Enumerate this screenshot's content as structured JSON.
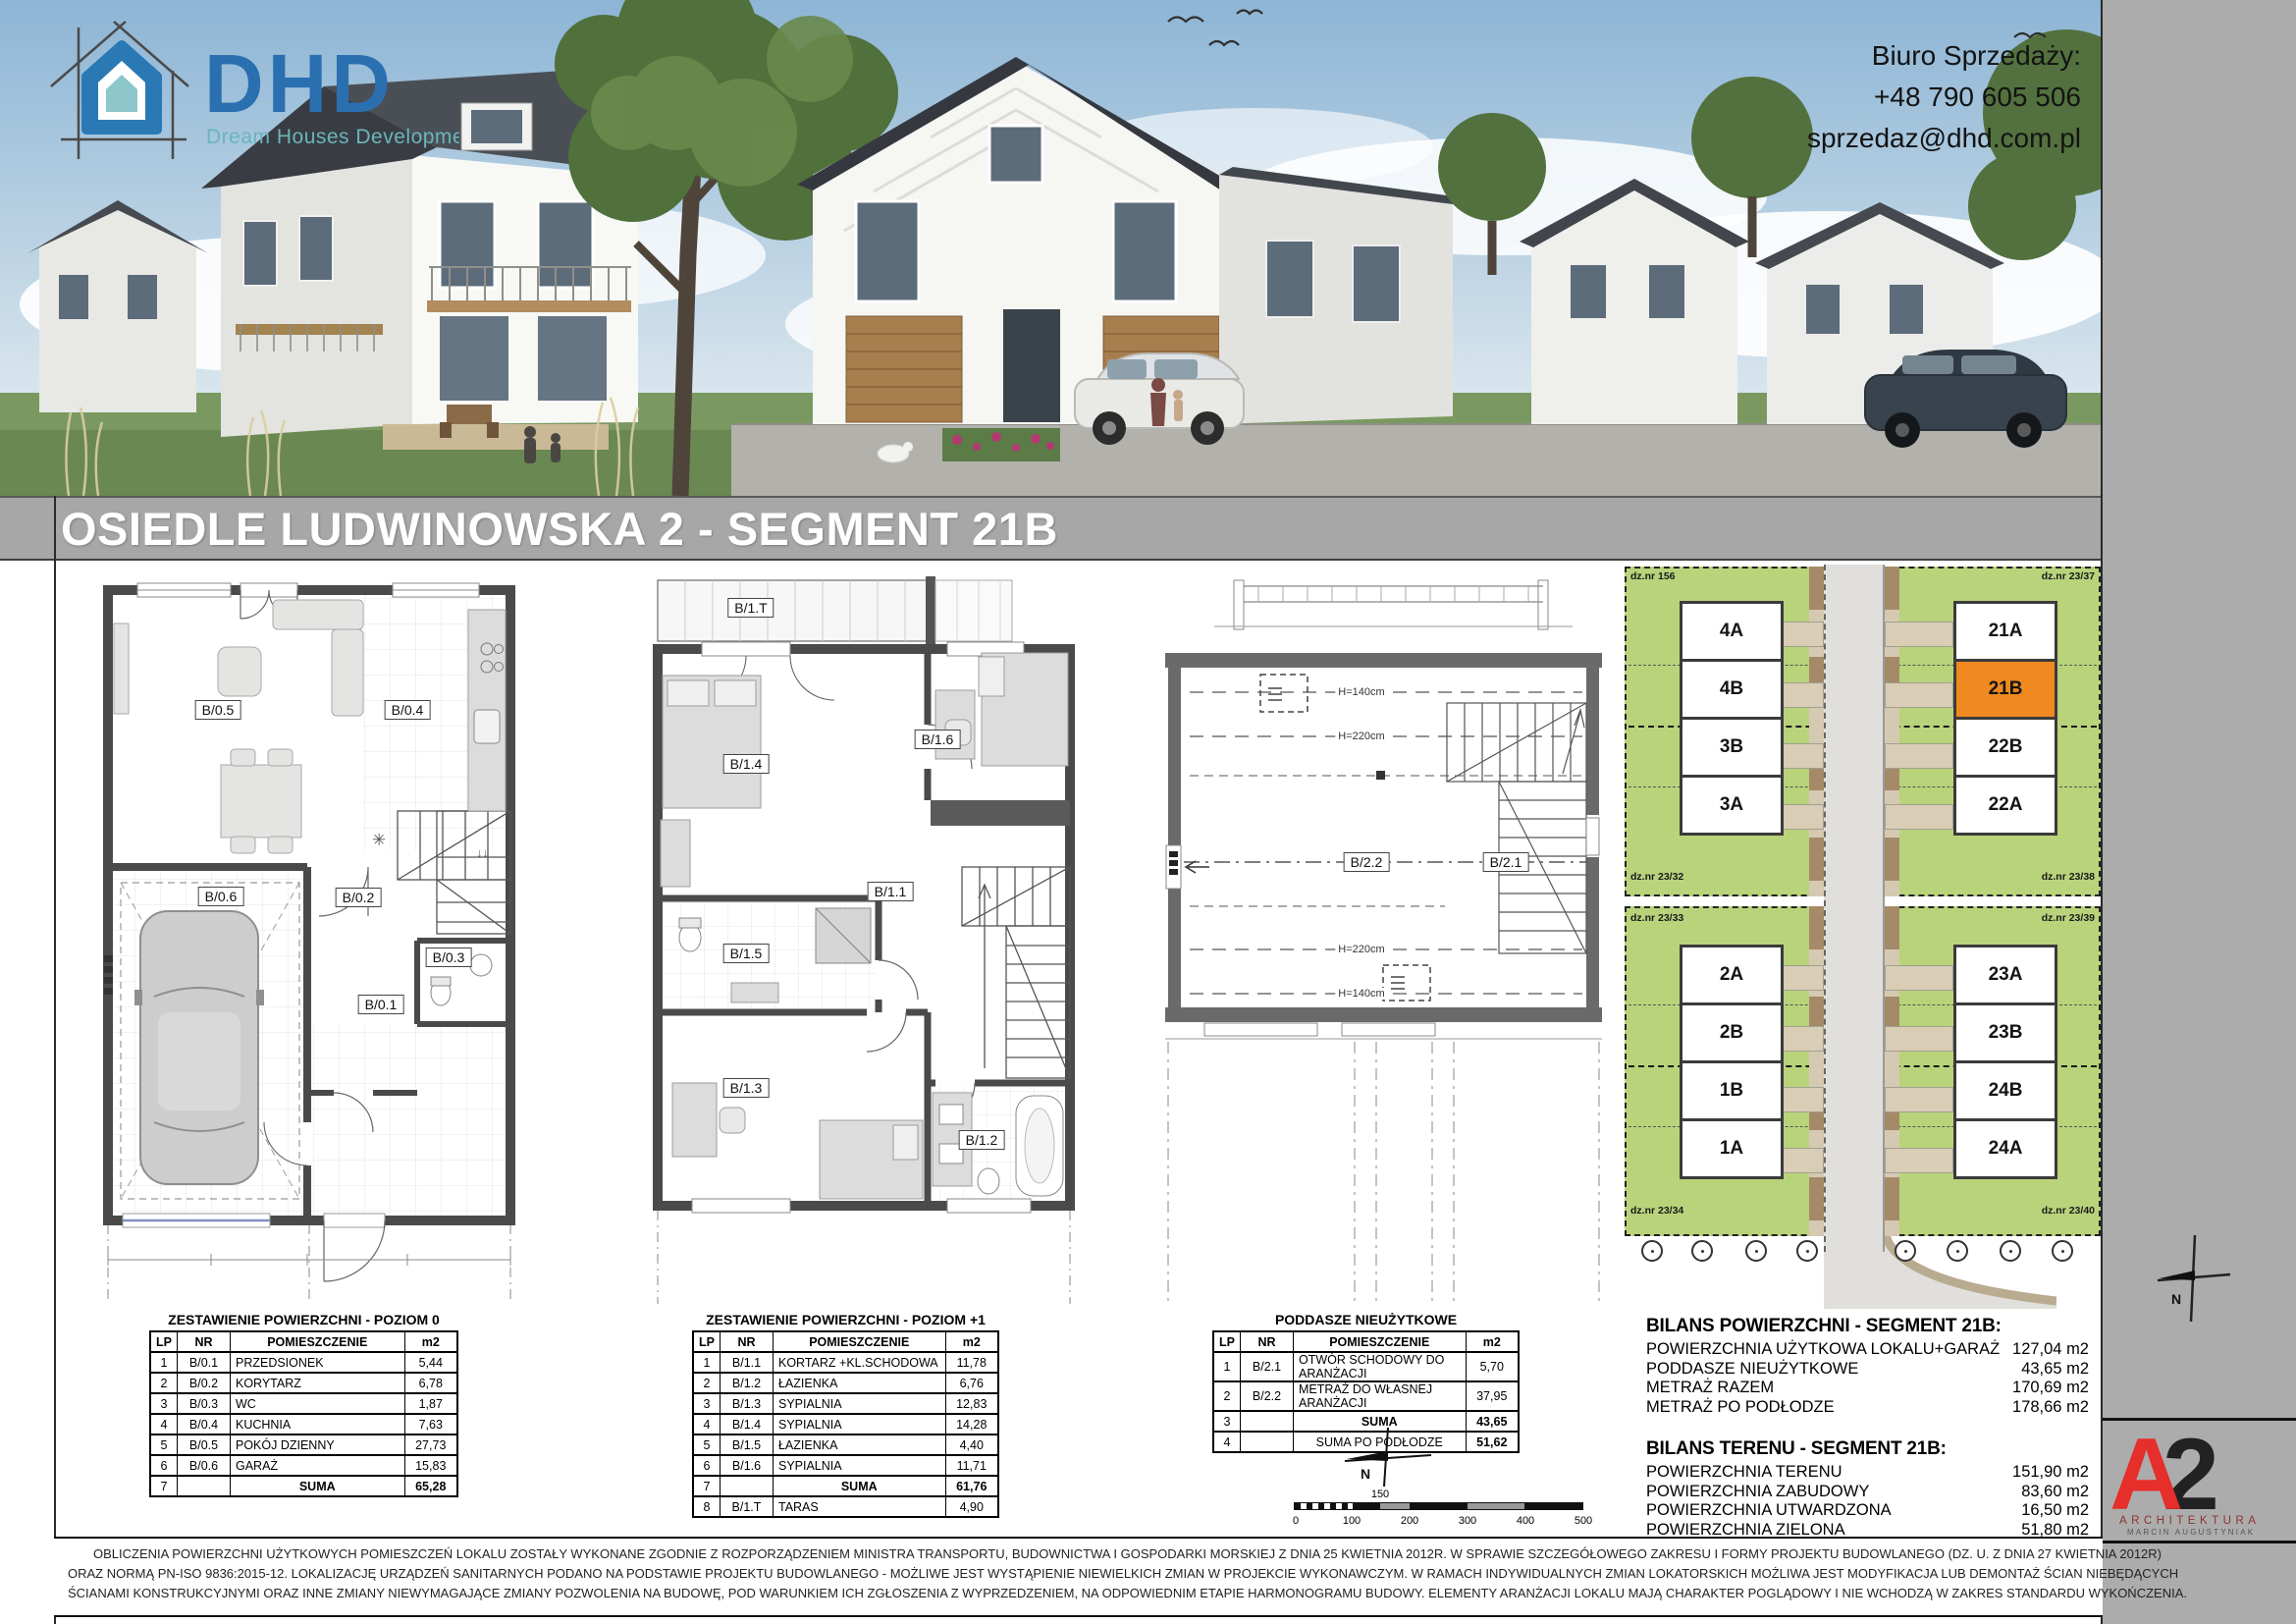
{
  "header": {
    "logo": {
      "abbr": "DHD",
      "tagline": "Dream Houses Development"
    },
    "contact": {
      "title": "Biuro Sprzedaży:",
      "phone": "+48 790 605 506",
      "email": "sprzedaz@dhd.com.pl"
    }
  },
  "banner": {
    "title": "OSIEDLE LUDWINOWSKA 2 - SEGMENT 21B"
  },
  "plans": {
    "p0": {
      "b01": "B/0.1",
      "b02": "B/0.2",
      "b03": "B/0.3",
      "b04": "B/0.4",
      "b05": "B/0.5",
      "b06": "B/0.6"
    },
    "p1": {
      "b11": "B/1.1",
      "b12": "B/1.2",
      "b13": "B/1.3",
      "b14": "B/1.4",
      "b15": "B/1.5",
      "b16": "B/1.6",
      "b1t": "B/1.T"
    },
    "p2": {
      "b21": "B/2.1",
      "b22": "B/2.2",
      "h140": "H=140cm",
      "h220": "H=220cm"
    }
  },
  "tables": [
    {
      "title": "ZESTAWIENIE POWIERZCHNI - POZIOM 0",
      "headers": [
        "LP",
        "NR",
        "POMIESZCZENIE",
        "m2"
      ],
      "rows": [
        {
          "cells": [
            "1",
            "B/0.1",
            "PRZEDSIONEK",
            "5,44"
          ]
        },
        {
          "cells": [
            "2",
            "B/0.2",
            "KORYTARZ",
            "6,78"
          ]
        },
        {
          "cells": [
            "3",
            "B/0.3",
            "WC",
            "1,87"
          ]
        },
        {
          "cells": [
            "4",
            "B/0.4",
            "KUCHNIA",
            "7,63"
          ]
        },
        {
          "cells": [
            "5",
            "B/0.5",
            "POKÓJ DZIENNY",
            "27,73"
          ]
        },
        {
          "cells": [
            "6",
            "B/0.6",
            "GARAŻ",
            "15,83"
          ]
        },
        {
          "cells": [
            "7",
            "",
            "SUMA",
            "65,28"
          ],
          "cls": "sum"
        }
      ]
    },
    {
      "title": "ZESTAWIENIE POWIERZCHNI - POZIOM +1",
      "headers": [
        "LP",
        "NR",
        "POMIESZCZENIE",
        "m2"
      ],
      "rows": [
        {
          "cells": [
            "1",
            "B/1.1",
            "KORTARZ +KL.SCHODOWA",
            "11,78"
          ]
        },
        {
          "cells": [
            "2",
            "B/1.2",
            "ŁAZIENKA",
            "6,76"
          ]
        },
        {
          "cells": [
            "3",
            "B/1.3",
            "SYPIALNIA",
            "12,83"
          ]
        },
        {
          "cells": [
            "4",
            "B/1.4",
            "SYPIALNIA",
            "14,28"
          ]
        },
        {
          "cells": [
            "5",
            "B/1.5",
            "ŁAZIENKA",
            "4,40"
          ]
        },
        {
          "cells": [
            "6",
            "B/1.6",
            "SYPIALNIA",
            "11,71"
          ]
        },
        {
          "cells": [
            "7",
            "",
            "SUMA",
            "61,76"
          ],
          "cls": "sum"
        },
        {
          "cells": [
            "8",
            "B/1.T",
            "TARAS",
            "4,90"
          ]
        }
      ]
    },
    {
      "title": "PODDASZE NIEUŻYTKOWE",
      "headers": [
        "LP",
        "NR",
        "POMIESZCZENIE",
        "m2"
      ],
      "rows": [
        {
          "cells": [
            "1",
            "B/2.1",
            "OTWÓR SCHODOWY DO ARANŻACJI",
            "5,70"
          ]
        },
        {
          "cells": [
            "2",
            "B/2.2",
            "METRAŻ DO WŁASNEJ ARANŻACJI",
            "37,95"
          ]
        },
        {
          "cells": [
            "3",
            "",
            "SUMA",
            "43,65"
          ],
          "cls": "sum"
        },
        {
          "cells": [
            "4",
            "",
            "SUMA PO PODŁODZE",
            "51,62"
          ],
          "cls": "sum2"
        }
      ]
    }
  ],
  "site_plan": {
    "plots": {
      "p156": "dz.nr 156",
      "p2337": "dz.nr 23/37",
      "p2332": "dz.nr 23/32",
      "p2338": "dz.nr 23/38",
      "p2333": "dz.nr 23/33",
      "p2339": "dz.nr 23/39",
      "p2334": "dz.nr 23/34",
      "p2340": "dz.nr 23/40"
    },
    "upper_left": [
      {
        "label": "4A"
      },
      {
        "label": "4B"
      },
      {
        "label": "3B"
      },
      {
        "label": "3A"
      }
    ],
    "upper_right": [
      {
        "label": "21A"
      },
      {
        "label": "21B",
        "cls": "hl"
      },
      {
        "label": "22B"
      },
      {
        "label": "22A"
      }
    ],
    "lower_left": [
      {
        "label": "2A"
      },
      {
        "label": "2B"
      },
      {
        "label": "1B"
      },
      {
        "label": "1A"
      }
    ],
    "lower_right": [
      {
        "label": "23A"
      },
      {
        "label": "23B"
      },
      {
        "label": "24B"
      },
      {
        "label": "24A"
      }
    ],
    "highlight_color": "#f0891f"
  },
  "bilans": {
    "areas_title": "BILANS POWIERZCHNI - SEGMENT 21B:",
    "areas": [
      {
        "label": "POWIERZCHNIA UŻYTKOWA LOKALU+GARAŻ",
        "value": "127,04 m2"
      },
      {
        "label": "PODDASZE NIEUŻYTKOWE",
        "value": "43,65 m2"
      },
      {
        "label": "METRAŻ RAZEM",
        "value": "170,69 m2"
      },
      {
        "label": "METRAŻ PO PODŁODZE",
        "value": "178,66 m2"
      }
    ],
    "site_title": "BILANS TERENU - SEGMENT 21B:",
    "site": [
      {
        "label": "POWIERZCHNIA TERENU",
        "value": "151,90 m2"
      },
      {
        "label": "POWIERZCHNIA ZABUDOWY",
        "value": "83,60 m2"
      },
      {
        "label": "POWIERZCHNIA UTWARDZONA",
        "value": "16,50 m2"
      },
      {
        "label": "POWIERZCHNIA ZIELONA",
        "value": "51,80 m2"
      }
    ]
  },
  "compass": {
    "north": "N"
  },
  "scale_bar": {
    "labels": [
      "0",
      "100",
      "200",
      "300",
      "400",
      "500"
    ],
    "mid": "150"
  },
  "a2_logo": {
    "letter_a": "A",
    "digit": "2",
    "line1": "ARCHITEKTURA",
    "line2": "MARCIN AUGUSTYNIAK"
  },
  "disclaimer": {
    "lines": [
      "OBLICZENIA POWIERZCHNI UŻYTKOWYCH POMIESZCZEŃ LOKALU ZOSTAŁY WYKONANE ZGODNIE Z ROZPORZĄDZENIEM MINISTRA TRANSPORTU, BUDOWNICTWA I GOSPODARKI MORSKIEJ Z DNIA 25 KWIETNIA 2012R. W SPRAWIE SZCZEGÓŁOWEGO ZAKRESU I FORMY PROJEKTU BUDOWLANEGO (DZ. U. Z DNIA 27 KWIETNIA 2012R)",
      "ORAZ NORMĄ PN-ISO 9836:2015-12. LOKALIZACJĘ URZĄDZEŃ SANITARNYCH PODANO NA PODSTAWIE PROJEKTU BUDOWLANEGO - MOŻLIWE JEST WYSTĄPIENIE NIEWIELKICH ZMIAN W PROJEKCIE WYKONAWCZYM. W RAMACH INDYWIDUALNYCH ZMIAN LOKATORSKICH MOŻLIWA JEST MODYFIKACJA LUB DEMONTAŻ ŚCIAN NIEBĘDĄCYCH",
      "ŚCIANAMI KONSTRUKCYJNYMI ORAZ INNE ZMIANY NIEWYMAGAJĄCE ZMIANY POZWOLENIA NA BUDOWĘ, POD WARUNKIEM ICH ZGŁOSZENIA Z WYPRZEDZENIEM, NA ODPOWIEDNIM ETAPIE HARMONOGRAMU BUDOWY. ELEMENTY ARANŻACJI LOKALU MAJĄ CHARAKTER POGLĄDOWY I NIE WCHODZĄ W ZAKRES STANDARDU WYKOŃCZENIA."
    ]
  }
}
